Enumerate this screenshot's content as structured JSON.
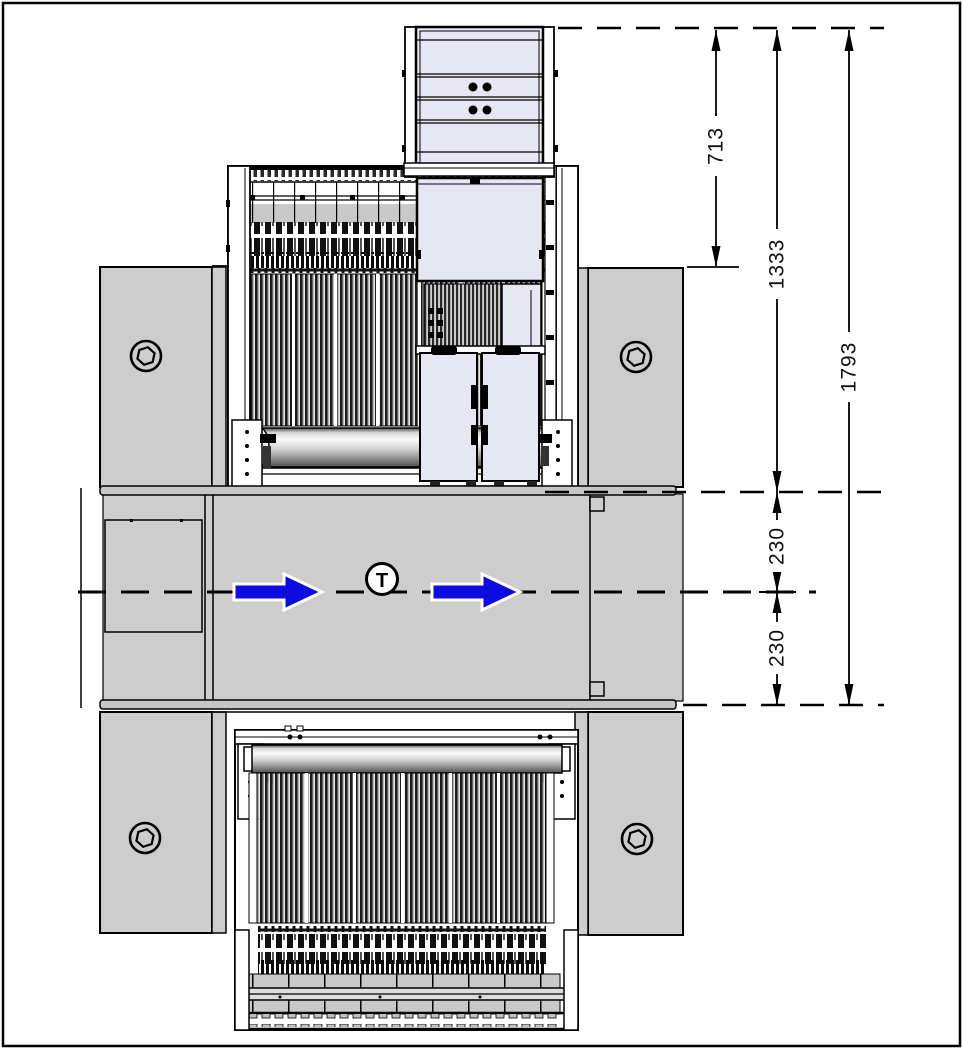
{
  "title": "machine top view technical drawing",
  "dimensions": {
    "module_height": "713",
    "upper_height": "1333",
    "total_height": "1793",
    "belt_upper": "230",
    "belt_lower": "230"
  },
  "flow": {
    "symbol": "T"
  },
  "colors": {
    "panel_gray": "#cdcdcd",
    "band_gray": "#c6c6c6",
    "box_fill": "#e7e7f3",
    "arrow_blue": "#0d0de0",
    "line": "#000000",
    "background": "#ffffff"
  }
}
